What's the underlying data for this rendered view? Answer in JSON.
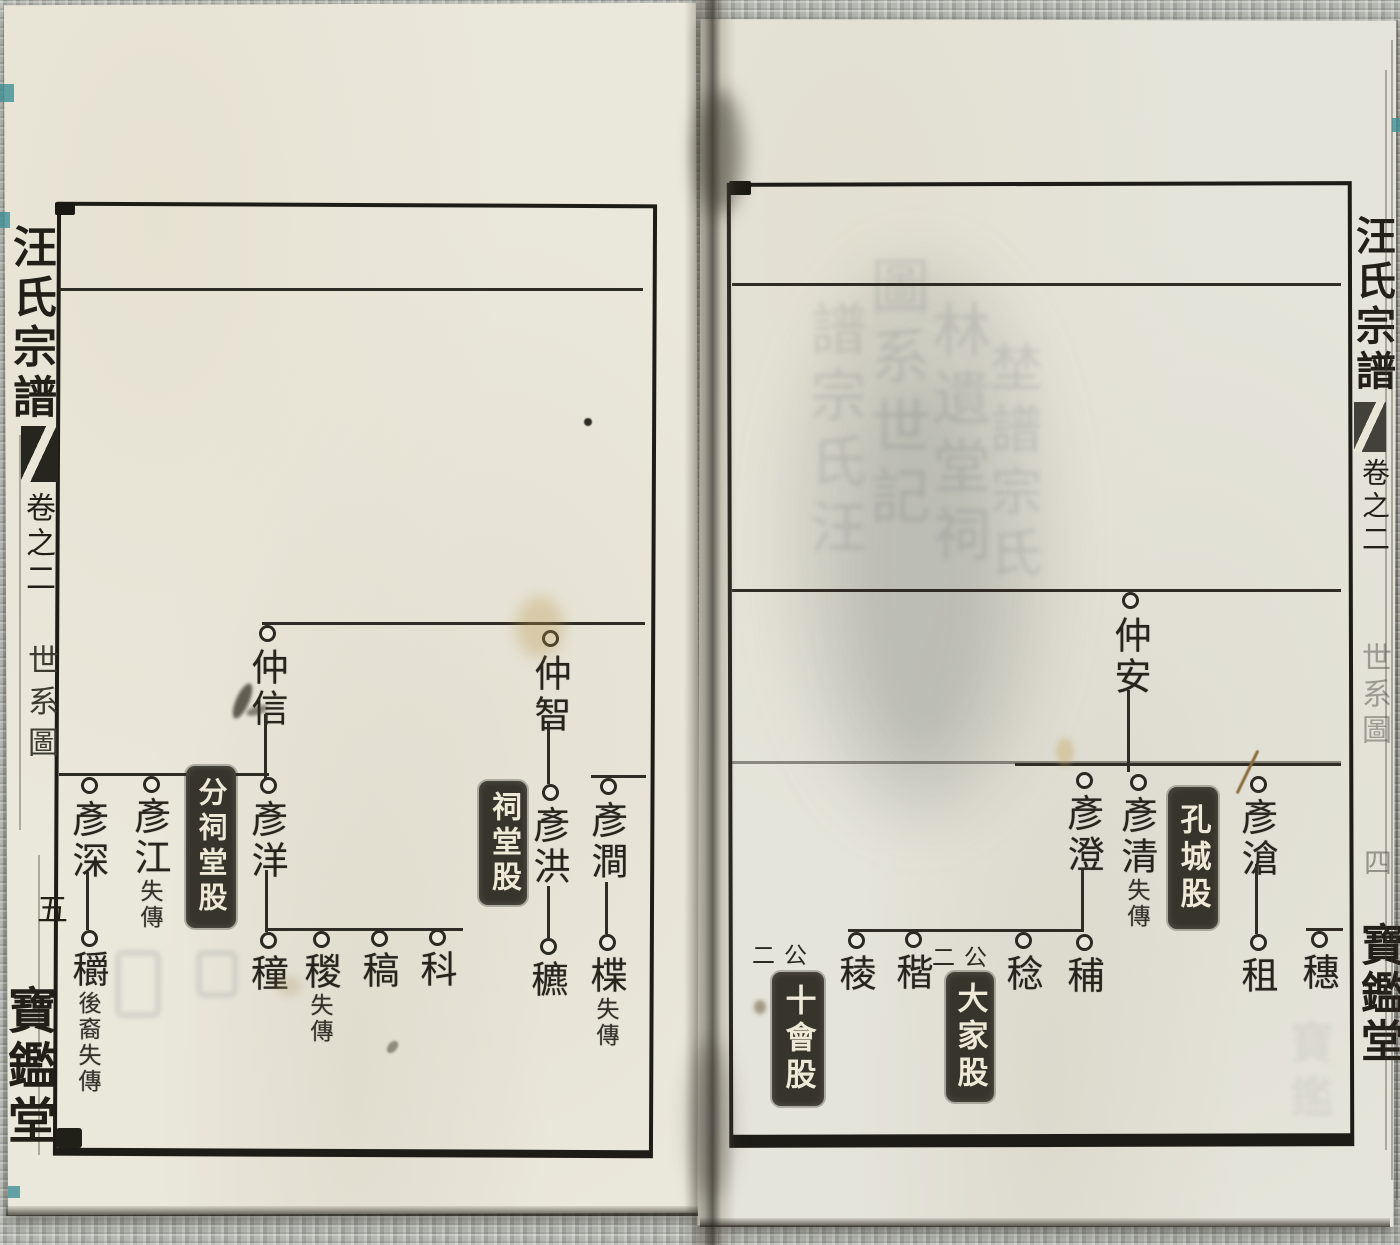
{
  "book": {
    "title": "汪氏宗譜",
    "volume": "卷之二",
    "section": "世系圖",
    "hall": "寶鑑堂",
    "left_page_number": "五",
    "right_page_number": "四"
  },
  "left_page": {
    "persons": {
      "zhongxin": {
        "name": "仲信"
      },
      "zhongzhi": {
        "name": "仲智"
      },
      "yanshen": {
        "name": "彥深"
      },
      "yanjiang": {
        "name": "彥江",
        "note": "失傳"
      },
      "yanyang": {
        "name": "彥洋"
      },
      "yanhong": {
        "name": "彥洪"
      },
      "yanjian": {
        "name": "彥澗"
      },
      "zhuo": {
        "name": "穱",
        "note": "後裔失傳"
      },
      "zhong": {
        "name": "穜"
      },
      "zong": {
        "name": "稯",
        "note": "失傳"
      },
      "gao": {
        "name": "稿"
      },
      "ke": {
        "name": "科"
      },
      "biao": {
        "name": "穮"
      },
      "die": {
        "name": "楪",
        "note": "失傳"
      }
    },
    "branch_boxes": {
      "fen_citang": {
        "label": "分祠堂股"
      },
      "citang": {
        "label": "祠堂股"
      }
    }
  },
  "right_page": {
    "persons": {
      "zhongan": {
        "name": "仲安"
      },
      "yancheng": {
        "name": "彥澄"
      },
      "yanqing": {
        "name": "彥清",
        "note": "失傳"
      },
      "yancang": {
        "name": "彥滄"
      },
      "leng": {
        "name": "稜"
      },
      "jie": {
        "name": "稭"
      },
      "ren": {
        "name": "稔"
      },
      "fu": {
        "name": "秿"
      },
      "zu": {
        "name": "租"
      },
      "sui": {
        "name": "穗"
      }
    },
    "branch_boxes": {
      "shihui": {
        "prefix": "二公",
        "label": "十會股"
      },
      "dajia": {
        "prefix": "二公",
        "label": "大家股"
      },
      "kongcheng": {
        "label": "孔城股"
      }
    },
    "bleedthrough": {
      "col1": "譜宗氏汪",
      "col2": "圖系世記",
      "col3": "林遺堂祠",
      "col4": "埜譜宗氏",
      "col5": "寶鑑"
    }
  }
}
